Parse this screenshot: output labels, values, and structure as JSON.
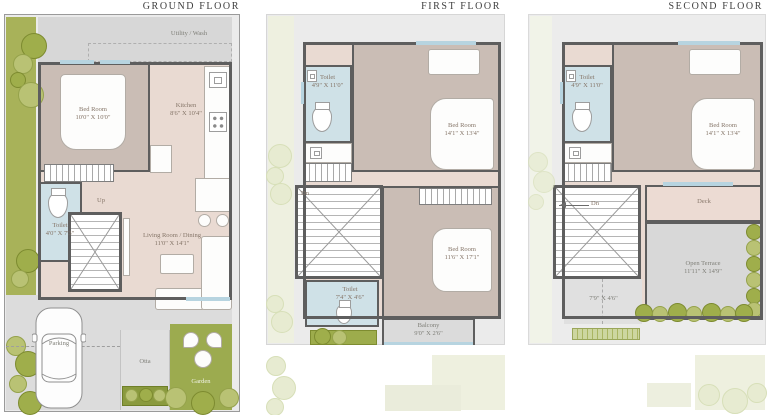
{
  "palette": {
    "wall": "#5e5e5e",
    "plot_gray": "#ebebeb",
    "floor_pink": "#e9dad2",
    "floor_tan": "#cabdb5",
    "toilet_blue": "#cfe1e7",
    "utility_gray": "#d7d7d7",
    "garden_green": "#9cab4f",
    "tree_olive": "#9fae4b",
    "window_blue": "#b7d4e0"
  },
  "floors": [
    {
      "title": "GROUND FLOOR",
      "rooms": {
        "utility": {
          "name": "Utility / Wash"
        },
        "bedroom": {
          "name": "Bed Room",
          "dims": "10'0\" X 10'0\""
        },
        "kitchen": {
          "name": "Kitchen",
          "dims": "8'6\" X 10'4\""
        },
        "toilet": {
          "name": "Toilet",
          "dims": "4'0\" X 7'3\""
        },
        "stairs": {
          "name": "Up"
        },
        "living": {
          "name": "Living Room / Dining",
          "dims": "11'0\" X 14'1\""
        },
        "parking": {
          "name": "Parking"
        },
        "otta": {
          "name": "Otta"
        },
        "garden": {
          "name": "Garden"
        }
      }
    },
    {
      "title": "FIRST FLOOR",
      "rooms": {
        "toilet_top": {
          "name": "Toilet",
          "dims": "4'9\" X 11'0\""
        },
        "bedroom_top": {
          "name": "Bed Room",
          "dims": "14'1\" X 13'4\""
        },
        "stairs": {
          "name": "Dn"
        },
        "toilet_bottom": {
          "name": "Toilet",
          "dims": "7'4\" X 4'6\""
        },
        "bedroom_bottom": {
          "name": "Bed Room",
          "dims": "11'6\" X 17'1\""
        },
        "balcony": {
          "name": "Balcony",
          "dims": "9'0\" X 2'6\""
        }
      }
    },
    {
      "title": "SECOND FLOOR",
      "rooms": {
        "toilet": {
          "name": "Toilet",
          "dims": "4'9\" X 11'0\""
        },
        "bedroom": {
          "name": "Bed Room",
          "dims": "14'1\" X 13'4\""
        },
        "stairs": {
          "name": "Dn"
        },
        "deck": {
          "name": "Deck"
        },
        "terrace": {
          "name": "Open Terrace",
          "dims": "11'11\" X 14'9\""
        },
        "passage": {
          "dims": "7'9\" X 4'6\""
        }
      }
    }
  ]
}
